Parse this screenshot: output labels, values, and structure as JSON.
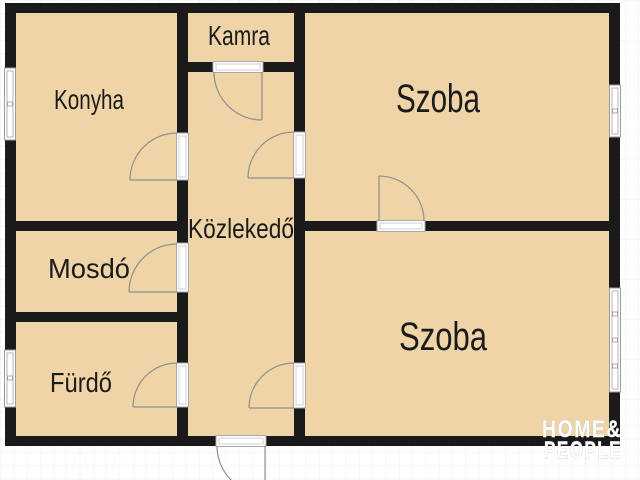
{
  "floor_plan": {
    "rooms": {
      "konyha": "Konyha",
      "kamra": "Kamra",
      "szoba_top": "Szoba",
      "kozlekedo": "Közlekedő",
      "mosdo": "Mosdó",
      "furdo": "Fürdő",
      "szoba_bottom": "Szoba"
    },
    "watermark": {
      "line1": "HOME&",
      "line2": "PEOPLE"
    },
    "colors": {
      "room_fill": "#eed4a6",
      "wall": "#1a1a1a",
      "background": "#ffffff",
      "grid_line": "#ececec",
      "door_arc": "#8f8f8f",
      "window_fill": "#ffffff",
      "label_text": "#1b1b1b",
      "watermark_text": "#ffffff"
    }
  }
}
